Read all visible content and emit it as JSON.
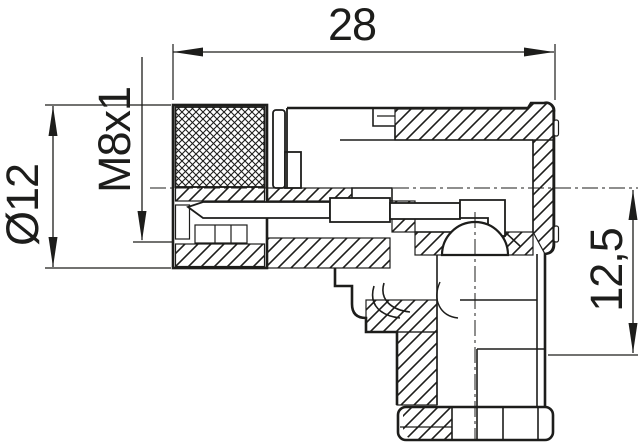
{
  "drawing": {
    "background": "#ffffff",
    "line_color": "#1d1d1b",
    "labels": {
      "width": "28",
      "diameter": "Ø12",
      "thread": "M8x1",
      "height": "12,5"
    }
  }
}
